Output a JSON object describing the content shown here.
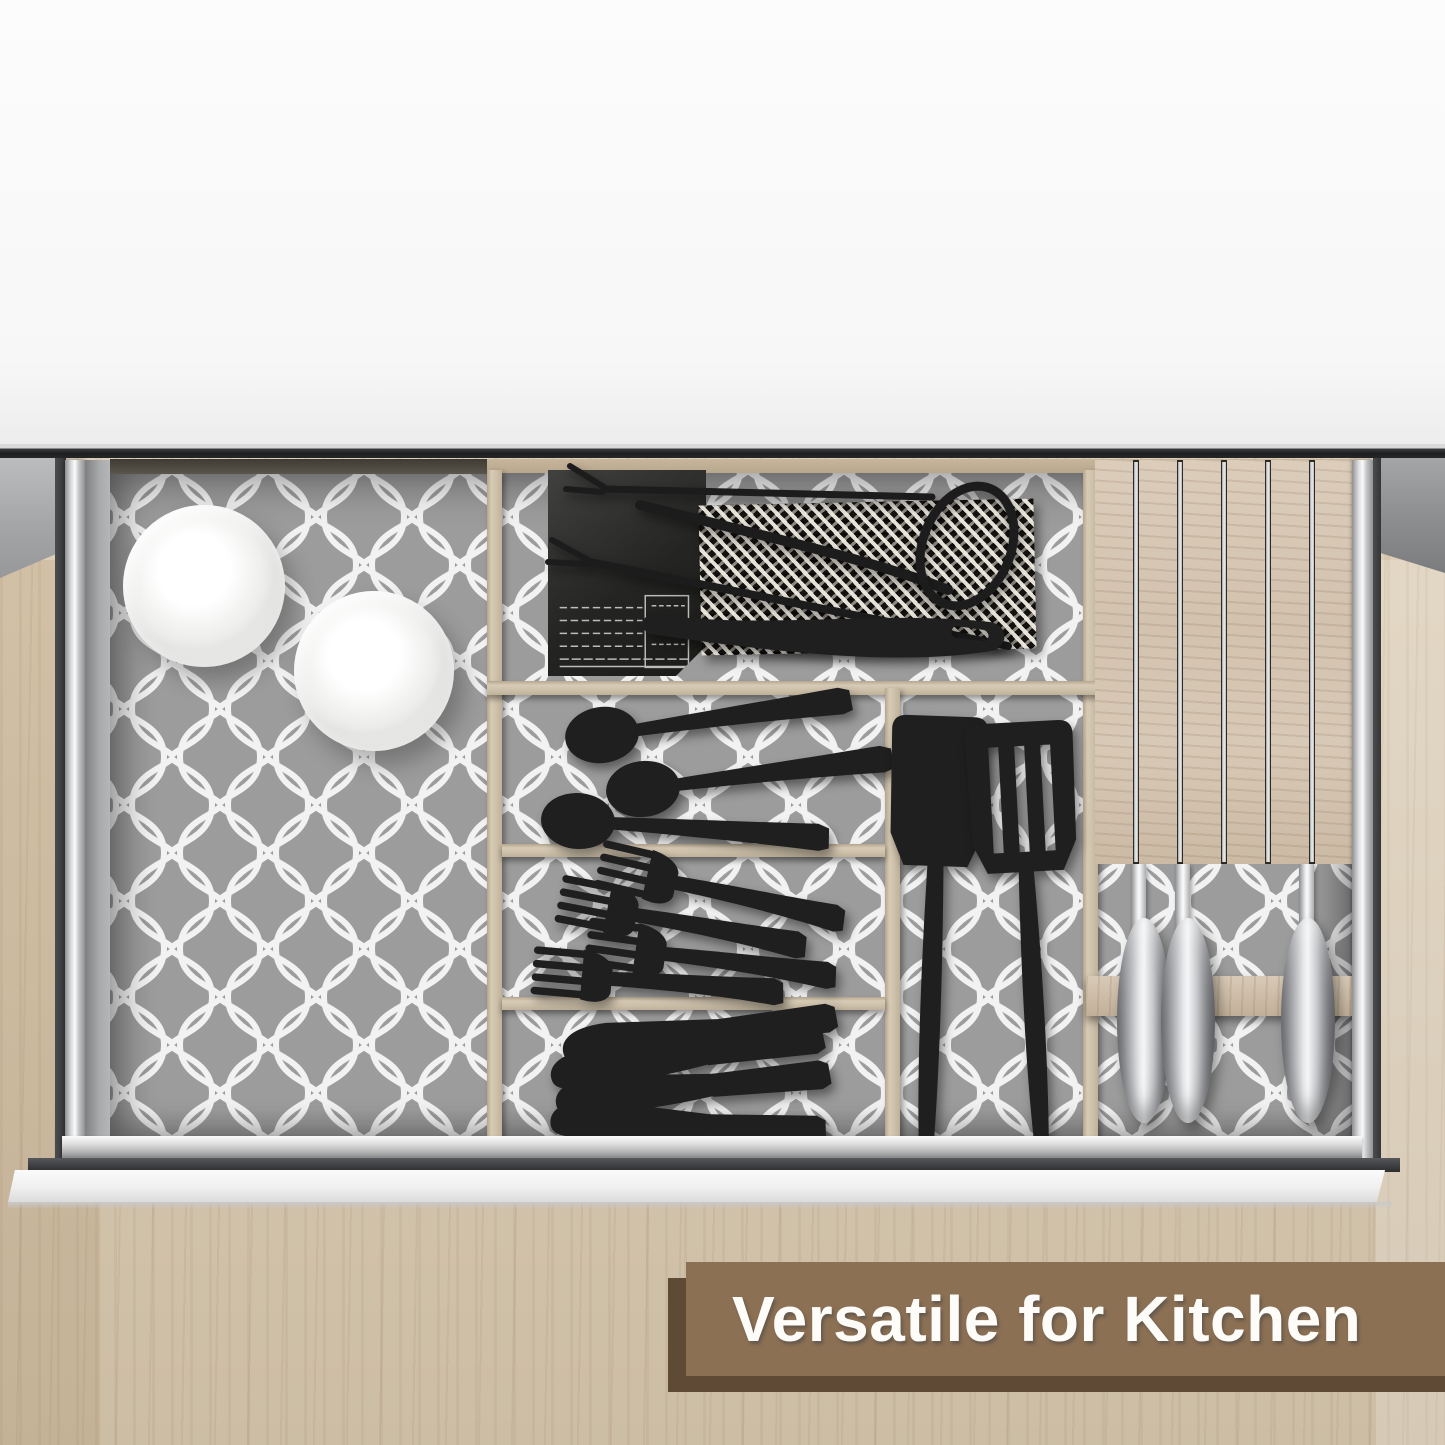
{
  "banner": {
    "label": "Versatile for Kitchen",
    "background": "#8c7054",
    "shadow": "#5e4a35",
    "text_color": "#fdfcf8"
  },
  "palette": {
    "wall_white": "#fbfbfb",
    "counter_wood": "#d9c9af",
    "liner_gray": "#9c9c9c",
    "liner_lattice": "#f3f3f3",
    "divider_wood": "#cfc2ac",
    "utensil_black": "#1f1f1f",
    "knife_steel": "#e8e9eb",
    "rail_silver": "#d9dadb"
  },
  "scene": {
    "items": [
      {
        "name": "ceramic-bowl",
        "count": 2
      },
      {
        "name": "black-spoon",
        "count": 3
      },
      {
        "name": "black-fork",
        "count": 4
      },
      {
        "name": "black-dinner-knife",
        "count": 4
      },
      {
        "name": "black-spatula",
        "count": 2
      },
      {
        "name": "steel-handled-knife",
        "count": 3
      },
      {
        "name": "knife-block-slat",
        "count": 6
      },
      {
        "name": "grill-tongs",
        "count": 1
      },
      {
        "name": "grill-fork",
        "count": 2
      },
      {
        "name": "woven-mat",
        "count": 1
      },
      {
        "name": "black-box",
        "count": 1
      }
    ]
  }
}
